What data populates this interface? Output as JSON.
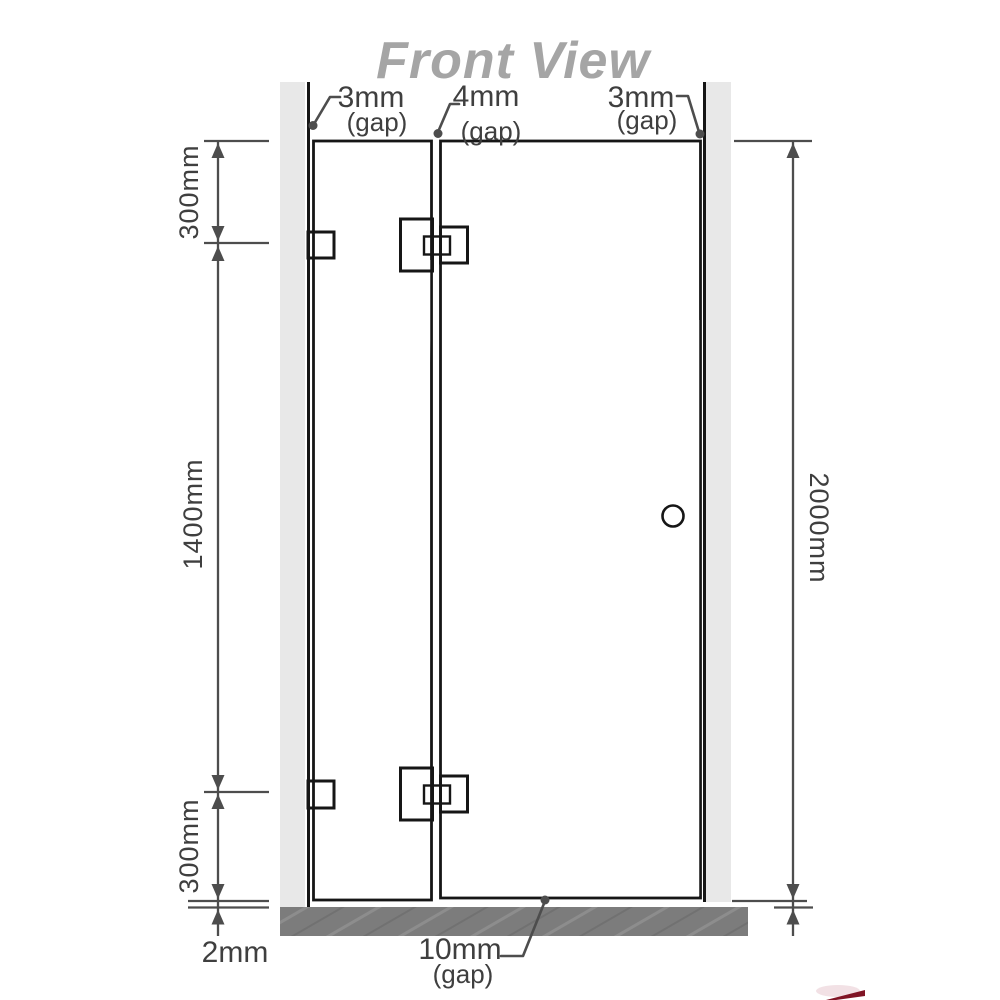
{
  "title": "Front View",
  "annotations": {
    "top_left_gap": {
      "value": "3mm",
      "suffix": "(gap)"
    },
    "top_middle_gap": {
      "value": "4mm",
      "suffix": "(gap)"
    },
    "top_right_gap": {
      "value": "3mm",
      "suffix": "(gap)"
    },
    "bottom_door_gap": {
      "value": "10mm",
      "suffix": "(gap)"
    },
    "floor_gap": {
      "value": "2mm"
    }
  },
  "dimensions": {
    "left_top": "300mm",
    "left_middle": "1400mm",
    "left_bottom": "300mm",
    "right_total": "2000mm"
  },
  "colors": {
    "glass_fixed": "#aadfc1",
    "glass_door": "#7cc89e",
    "wall": "#e8e8e8",
    "floor": "#7c7c7c",
    "dimension_lines": "#4d4d4d",
    "title": "#a5a5a5"
  }
}
